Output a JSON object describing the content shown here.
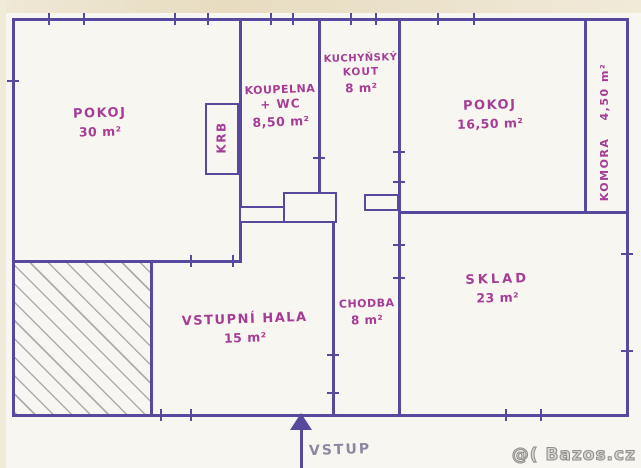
{
  "meta": {
    "kind": "hand-drawn floor plan (scanned sketch)",
    "colors": {
      "wall_ink": "#574a9e",
      "label_ink": "#a53c96",
      "entry_ink": "#8d87a2",
      "paper": "#f8f6f0",
      "paper_edge": "#e7dcc0",
      "hatch_pencil": "#706e76",
      "watermark_gray": "#8f8d8a"
    }
  },
  "rooms": [
    {
      "id": "pokoj-30",
      "name": "POKOJ",
      "area": "30 m²"
    },
    {
      "id": "krb",
      "name": "KRB"
    },
    {
      "id": "koupelna",
      "name": "KOUPELNA",
      "name2": "+ WC",
      "area": "8,50 m²"
    },
    {
      "id": "kuchynsky-kout",
      "name": "KUCHYŇSKÝ",
      "name2": "KOUT",
      "area": "8 m²"
    },
    {
      "id": "pokoj-16",
      "name": "POKOJ",
      "area": "16,50 m²"
    },
    {
      "id": "komora",
      "name": "KOMORA",
      "area": "4,50 m²"
    },
    {
      "id": "sklad",
      "name": "SKLAD",
      "area": "23 m²"
    },
    {
      "id": "chodba",
      "name": "CHODBA",
      "area": "8 m²"
    },
    {
      "id": "vstupni-hala",
      "name": "VSTUPNÍ HALA",
      "area": "15 m²"
    }
  ],
  "entry": {
    "label": "VSTUP"
  },
  "watermark": {
    "text": "@( Bazos.cz"
  }
}
